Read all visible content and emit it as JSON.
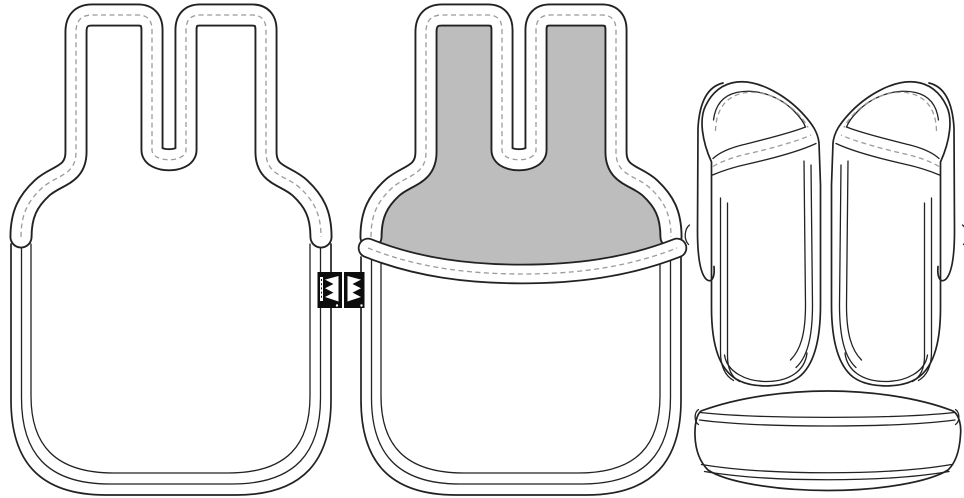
{
  "scene": {
    "width": 964,
    "height": 498,
    "background": "#ffffff"
  },
  "palette": {
    "outline": "#222222",
    "stitch_dash": "#9b9b9b",
    "panel_gray": "#bdbdbd",
    "fabric_white": "#ffffff",
    "tag_black": "#0d0d0d",
    "tag_white": "#ffffff"
  },
  "figures": {
    "pouch_back": {
      "name": "pouch-back-view"
    },
    "pouch_front": {
      "name": "pouch-front-view-with-pocket"
    },
    "tag_back": {
      "name": "brand-tag-back-side",
      "glyph": "crown-zigzag-pointing-left"
    },
    "tag_front": {
      "name": "brand-tag-front-side",
      "glyph": "crown-zigzag-pointing-right"
    },
    "slipper_left": {
      "name": "slipper-left-top-view"
    },
    "slipper_right": {
      "name": "slipper-right-top-view"
    },
    "case": {
      "name": "round-case-side-view"
    }
  }
}
